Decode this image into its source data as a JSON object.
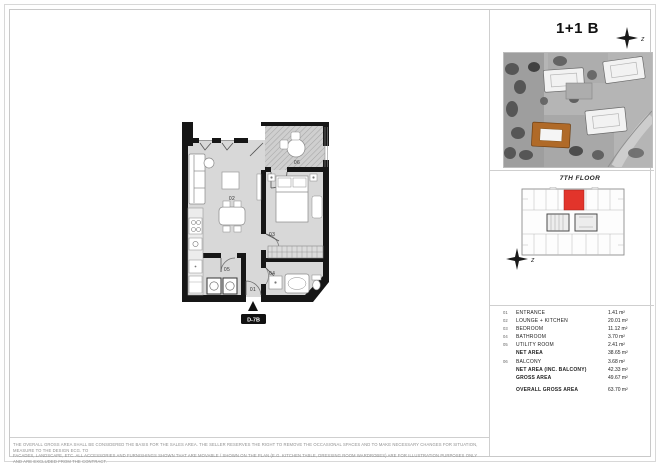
{
  "sheet": {
    "title": "1+1 B",
    "floor_label": "7TH FLOOR",
    "unit_code": "D-7B",
    "north_letter": "z"
  },
  "plan": {
    "labels": {
      "entrance": "01",
      "lounge": "02",
      "bedroom": "03",
      "bathroom": "04",
      "utility": "05",
      "balcony": "06"
    }
  },
  "area_table": {
    "rows": [
      {
        "num": "01",
        "label": "ENTRANCE",
        "value": "1.41 m²"
      },
      {
        "num": "02",
        "label": "LOUNGE + KITCHEN",
        "value": "20.01 m²"
      },
      {
        "num": "03",
        "label": "BEDROOM",
        "value": "11.12 m²"
      },
      {
        "num": "04",
        "label": "BATHROOM",
        "value": "3.70 m²"
      },
      {
        "num": "05",
        "label": "UTILITY ROOM",
        "value": "2.41 m²"
      },
      {
        "num": "",
        "label": "NET AREA",
        "value": "38.65 m²"
      },
      {
        "num": "06",
        "label": "BALCONY",
        "value": "3.68 m²"
      },
      {
        "num": "",
        "label": "NET AREA (INC. BALCONY)",
        "value": "42.33 m²"
      },
      {
        "num": "",
        "label": "GROSS AREA",
        "value": "49.67 m²"
      },
      {
        "num": "",
        "label": "OVERALL GROSS AREA",
        "value": "63.70 m²"
      }
    ]
  },
  "disclaimer": {
    "line1": "THE OVERALL GROSS AREA SHALL BE CONSIDERED THE BASIS FOR THE SALES AREA. THE SELLER RESERVES THE RIGHT TO REMOVE THE OCCASIONAL SPACES AND TO MAKE NECESSARY CHANGES FOR SITUATION, MEASURE TO THE DESIGN ECG. TO",
    "line2": "FACADES, LANDSCAPE, ETC. ALL ACCESSORIES AND FURNISHINGS SHOWN THAT ARE MOVABLE / SHOWN ON THE PLAN (E.G. KITCHEN TABLE, DRESSING ROOM WARDROBES) ARE FOR ILLUSTRATION PURPOSES ONLY AND ARE EXCLUDED FROM THE CONTRACT."
  },
  "colors": {
    "unit_highlight": "#e2342b",
    "site_building_accent": "#b06a28",
    "plan_floor": "#d8d8d8",
    "wall": "#161616"
  }
}
